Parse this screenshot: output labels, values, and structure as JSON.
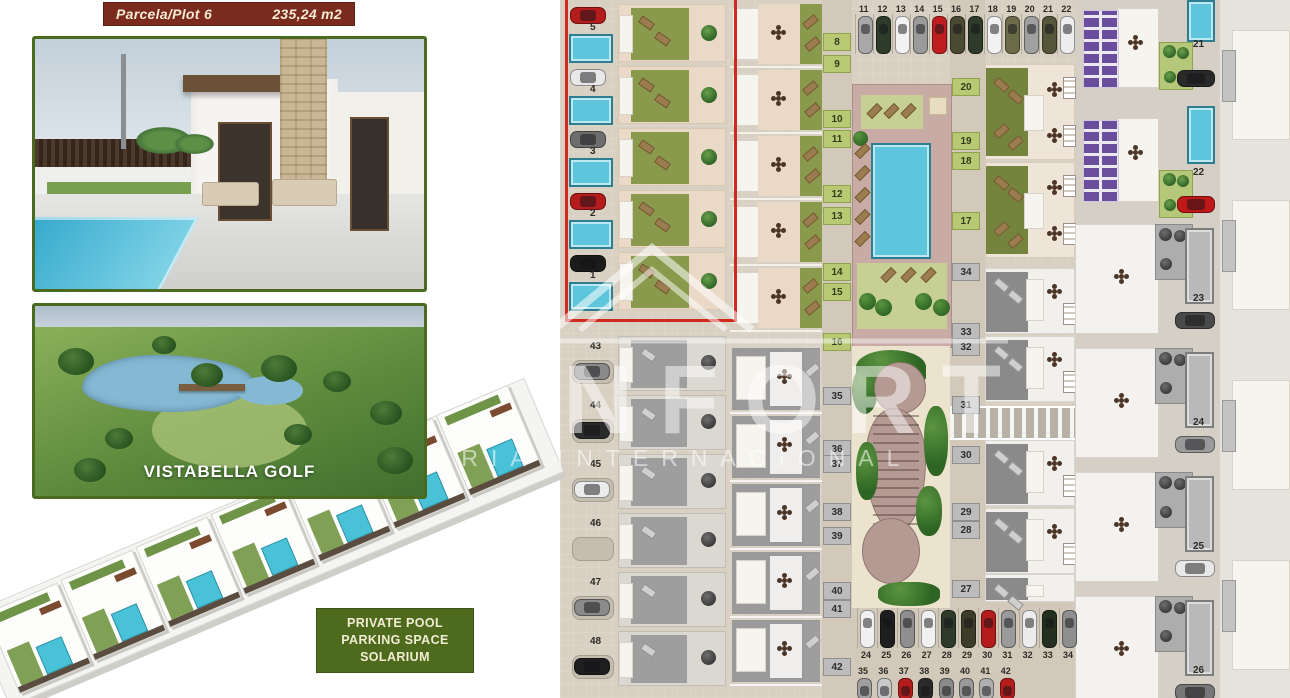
{
  "plot_badge": {
    "label": "Parcela/Plot 6",
    "area": "235,24  m2"
  },
  "golf_photo": {
    "caption": "VISTABELLA GOLF"
  },
  "features_badge": {
    "line1": "PRIVATE POOL",
    "line2": "PARKING SPACE",
    "line3": "SOLARIUM"
  },
  "watermark": {
    "word_large": "NFORT",
    "word_small": "ARIA INTERNACIONAL"
  },
  "colors": {
    "badge_bg": "#7b2b1d",
    "badge_text": "#f5ead3",
    "features_bg": "#4e6a1d",
    "photo_border": "#4a6b1f",
    "highlight_red": "#d02a20",
    "pool_blue": "#5ec6dc",
    "garden_olive": "#8a9a4c",
    "solar_purple": "#6a4e9d"
  },
  "plan": {
    "red_block_units": [
      {
        "n": "5",
        "car": "#b51c1c"
      },
      {
        "n": "4",
        "car": "#e8e8e8"
      },
      {
        "n": "3",
        "car": "#6e6e6e"
      },
      {
        "n": "2",
        "car": "#b51c1c"
      },
      {
        "n": "1",
        "car": "#1c1c1c"
      }
    ],
    "left_gray_units": [
      {
        "n": "43",
        "car": "#8a8a8a"
      },
      {
        "n": "44",
        "car": "#2a2a2a"
      },
      {
        "n": "45",
        "car": "#ececec"
      },
      {
        "n": "46",
        "car": null
      },
      {
        "n": "47",
        "car": "#8a8a8a"
      },
      {
        "n": "48",
        "car": "#1e1e1e"
      }
    ],
    "mid_units_green": [
      "8",
      "9",
      "10",
      "11",
      "12",
      "13",
      "14",
      "15",
      "16"
    ],
    "mid_units_gray": [
      "35",
      "36",
      "37",
      "38",
      "39",
      "40",
      "41",
      "42"
    ],
    "right_units_green": [
      "20",
      "19",
      "18",
      "17"
    ],
    "right_units_gray": [
      "34",
      "33",
      "32",
      "31",
      "30",
      "29",
      "28",
      "27"
    ],
    "villas": [
      {
        "n": "21",
        "car": "#2a2a2a"
      },
      {
        "n": "22",
        "car": "#c01818"
      },
      {
        "n": "23",
        "car": "#4a4a4a"
      },
      {
        "n": "24",
        "car": "#9a9a9a"
      },
      {
        "n": "25",
        "car": "#e8e8e8"
      },
      {
        "n": "26",
        "car": "#777777"
      }
    ],
    "parking_top": [
      {
        "n": "11",
        "car": "#a8a8a8"
      },
      {
        "n": "12",
        "car": "#2e3b2a"
      },
      {
        "n": "13",
        "car": "#f2f2f2"
      },
      {
        "n": "14",
        "car": "#9a9a9a"
      },
      {
        "n": "15",
        "car": "#c01e1e"
      },
      {
        "n": "16",
        "car": "#4a4a32"
      },
      {
        "n": "17",
        "car": "#2e3b2a"
      },
      {
        "n": "18",
        "car": "#f2f2f2"
      },
      {
        "n": "19",
        "car": "#6b6b4a"
      },
      {
        "n": "20",
        "car": "#a0a0a0"
      },
      {
        "n": "21",
        "car": "#55553a"
      },
      {
        "n": "22",
        "car": "#ededed"
      }
    ],
    "parking_mid": [
      {
        "n": "24",
        "car": "#f0f0f0"
      },
      {
        "n": "25",
        "car": "#1e1e1e"
      },
      {
        "n": "26",
        "car": "#8f8f8f"
      },
      {
        "n": "27",
        "car": "#f0f0f0"
      },
      {
        "n": "28",
        "car": "#2e3b2a"
      },
      {
        "n": "29",
        "car": "#3c3c28"
      },
      {
        "n": "30",
        "car": "#b51c1c"
      },
      {
        "n": "31",
        "car": "#9a9a9a"
      },
      {
        "n": "32",
        "car": "#ececec"
      },
      {
        "n": "33",
        "car": "#23301f"
      },
      {
        "n": "34",
        "car": "#8f8f8f"
      }
    ],
    "parking_low": [
      {
        "n": "35",
        "car": "#a0a0a0"
      },
      {
        "n": "36",
        "car": "#c8c8c8"
      },
      {
        "n": "37",
        "car": "#b51c1c"
      },
      {
        "n": "38",
        "car": "#2a2a2a"
      },
      {
        "n": "39",
        "car": "#8a8a8a"
      },
      {
        "n": "40",
        "car": "#9a9a9a"
      },
      {
        "n": "41",
        "car": "#b0b0b0"
      },
      {
        "n": "42",
        "car": "#b51c1c"
      }
    ]
  }
}
